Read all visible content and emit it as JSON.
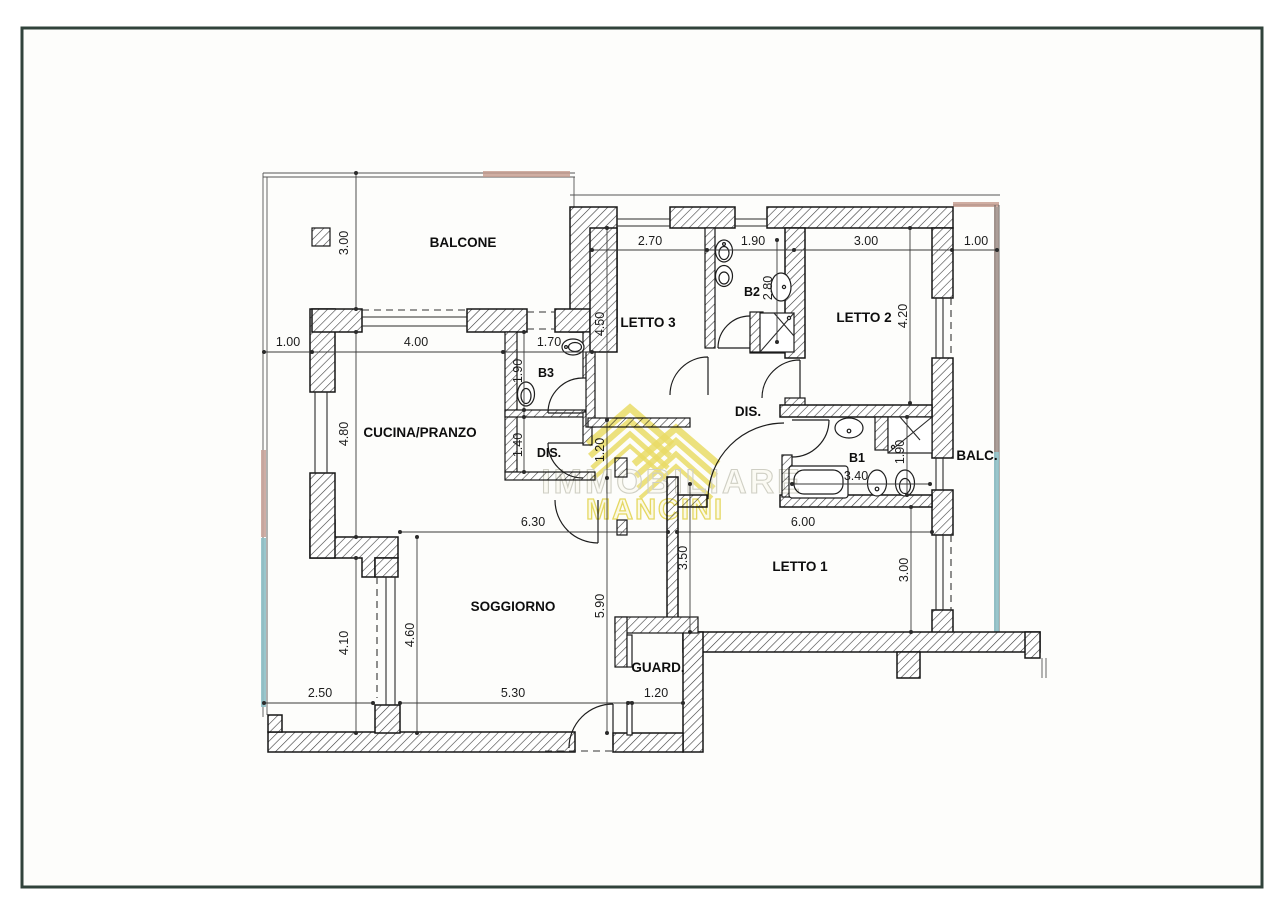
{
  "page": {
    "background": "#fdfdfb",
    "border_color": "#31433b"
  },
  "watermark": {
    "line1": "IMMOBILIARE",
    "line2": "MANCINI",
    "color": "#e7d74d"
  },
  "accents": {
    "terrace_pink": "#c9a49b",
    "terrace_teal": "#8fc0c6",
    "balcony_brown": "#9d8d86",
    "railing_salmon": "#c49a8c"
  },
  "rooms": {
    "balcone": "BALCONE",
    "cucina": "CUCINA/PRANZO",
    "soggiorno": "SOGGIORNO",
    "letto1": "LETTO 1",
    "letto2": "LETTO 2",
    "letto3": "LETTO 3",
    "dis_main": "DIS.",
    "dis_small": "DIS.",
    "b1": "B1",
    "b2": "B2",
    "b3": "B3",
    "guard": "GUARD.",
    "balc": "BALC."
  },
  "dims": {
    "letto3_w": "2.70",
    "b2_w": "1.90",
    "letto2_w": "3.00",
    "balc_top_w": "1.00",
    "left_offset": "1.00",
    "cucina_w": "4.00",
    "b3_top_w": "1.70",
    "balcone_h": "3.00",
    "letto3_h": "4.50",
    "b2_h": "2.80",
    "letto2_h": "4.20",
    "b3_h": "1.90",
    "dis_small_h": "1.40",
    "cucina_h": "4.80",
    "passage_h": "1.20",
    "soggiorno_w": "6.30",
    "letto1_w": "6.00",
    "b1_w": "3.40",
    "b1_h": "1.90",
    "letto1_split_h": "3.50",
    "soggiorno_full_h": "5.90",
    "letto1_h": "3.00",
    "terrace_h": "4.10",
    "soggiorno_h": "4.60",
    "terrace_w": "2.50",
    "soggiorno_bottom_w": "5.30",
    "guard_w": "1.20"
  }
}
